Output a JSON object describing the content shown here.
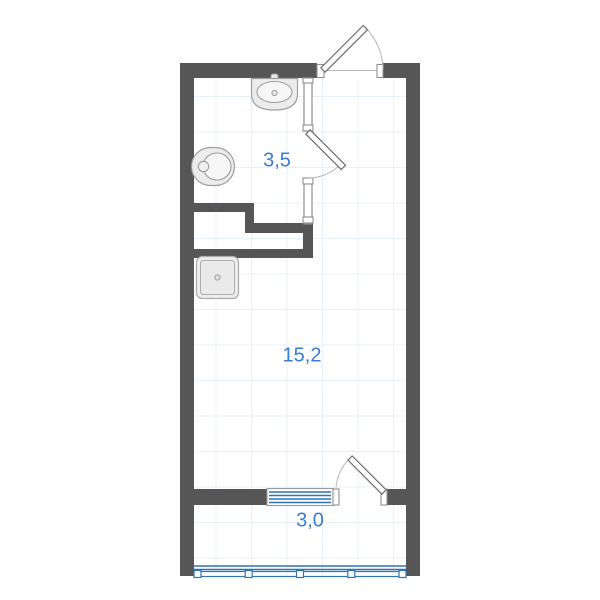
{
  "colors": {
    "wall": "#565656",
    "accent": "#3b7cd5",
    "window": "#2e74b5",
    "grid": "#e8f1fa",
    "outline": "#8f8f8f",
    "arc": "#b8b8b8",
    "fixture_fill": "#ececec",
    "fixture_stroke": "#9f9f9f"
  },
  "plan": {
    "type": "studio-apartment-floor-plan",
    "rooms": [
      {
        "name": "bathroom",
        "area": "3,5"
      },
      {
        "name": "living-room",
        "area": "15,2"
      },
      {
        "name": "balcony",
        "area": "3,0"
      }
    ],
    "fixtures": [
      "sink",
      "toilet",
      "washing-machine"
    ],
    "doors": [
      "entry-door",
      "bathroom-door",
      "balcony-door"
    ],
    "openings": [
      "balcony-window",
      "balcony-glazing"
    ]
  }
}
